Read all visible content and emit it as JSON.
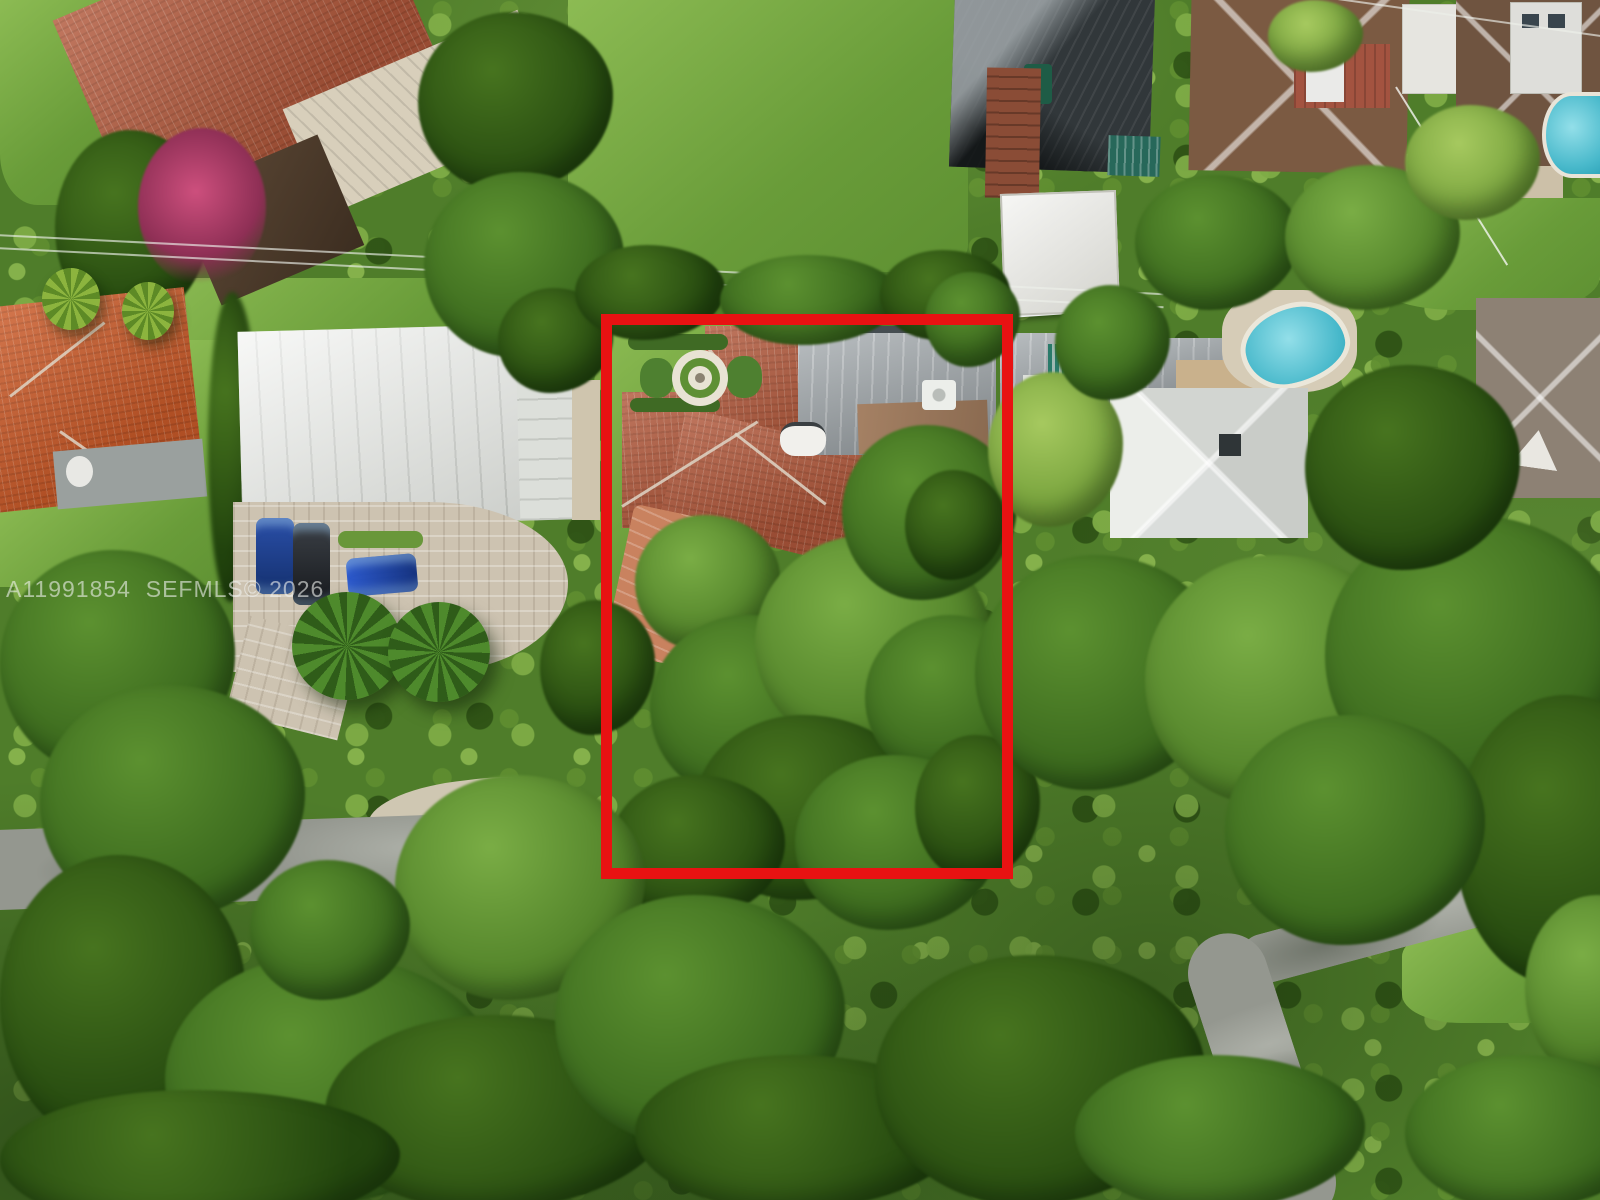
{
  "watermark": {
    "text": "A11991854  SEFMLS© 2026",
    "mls_number": "A11991854",
    "source": "SEFMLS©",
    "year": "2026"
  },
  "colors": {
    "lot_outline_red": "#e81212",
    "tree_green_dark": "#23460e",
    "tree_green_mid": "#5c9130",
    "tree_green_light": "#7aad45",
    "lawn_green": "#7cb04a",
    "terracotta_roof": "#b2593c",
    "orange_tile_roof": "#cd5c2a",
    "white_metal_roof": "#e9ebe7",
    "gray_flat_roof": "#9aa1a5",
    "brown_shingle_roof": "#7b5a42",
    "pool_turquoise": "#5ec7d6",
    "road_gray": "#94978f",
    "driveway_paver": "#cdc3b1",
    "watermark_text": "#f0f2ef"
  }
}
